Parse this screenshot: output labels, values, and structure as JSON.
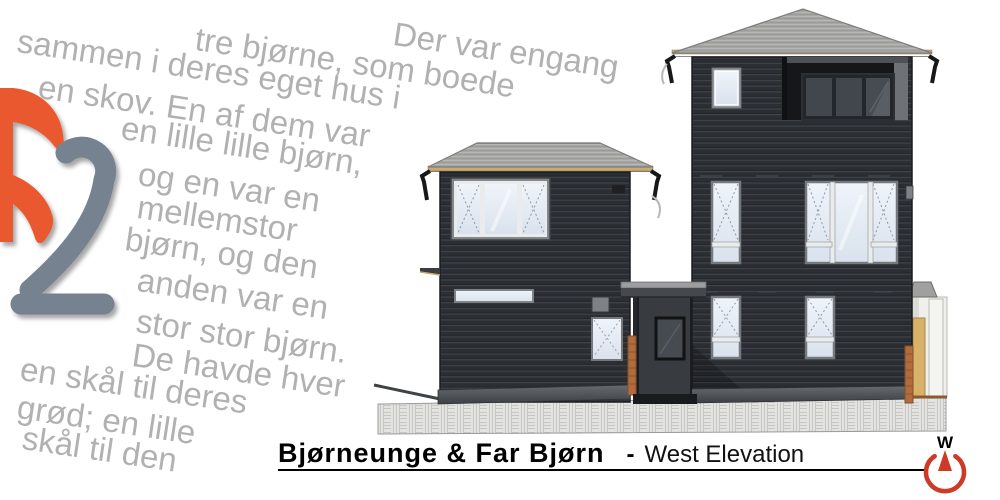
{
  "page": {
    "background": "#ffffff"
  },
  "logo": {
    "meaning": "b2 logo",
    "letter_b_color": "#e9582e",
    "digit_2_color": "#76828f"
  },
  "story": {
    "text_color": "#b1b1b1",
    "lines": [
      "Der var engang",
      "tre bjørne, som boede",
      "sammen i deres eget hus i",
      "en skov. En af dem var",
      "en lille lille bjørn,",
      "og en var en",
      "mellemstor",
      "bjørn, og den",
      "anden var en",
      "stor stor bjørn.",
      "De havde hver",
      "en skål til deres",
      "grød; en lille",
      "skål til den"
    ]
  },
  "titlebar": {
    "project_title": "Bjørneunge & Far Bjørn",
    "separator": "-",
    "view_label": "West Elevation",
    "rule_color": "#000000"
  },
  "compass": {
    "letter": "W",
    "ring_color": "#cd3b28"
  },
  "drawing": {
    "description": "West elevation of two dark-sided buildings with entry porch",
    "palette": {
      "siding": "#2b2f34",
      "siding_line": "#40464c",
      "roof": "#a7a7a5",
      "fascia": "#c9ab72",
      "window_pane": "#e7edf5",
      "window_frame": "#74797e",
      "cedar_trim": "#b26b3c",
      "canopy": "#45484d",
      "ground_hatch": "#e3e3e1",
      "base_band": "#565b60",
      "dark_glass": "#42474e"
    }
  }
}
